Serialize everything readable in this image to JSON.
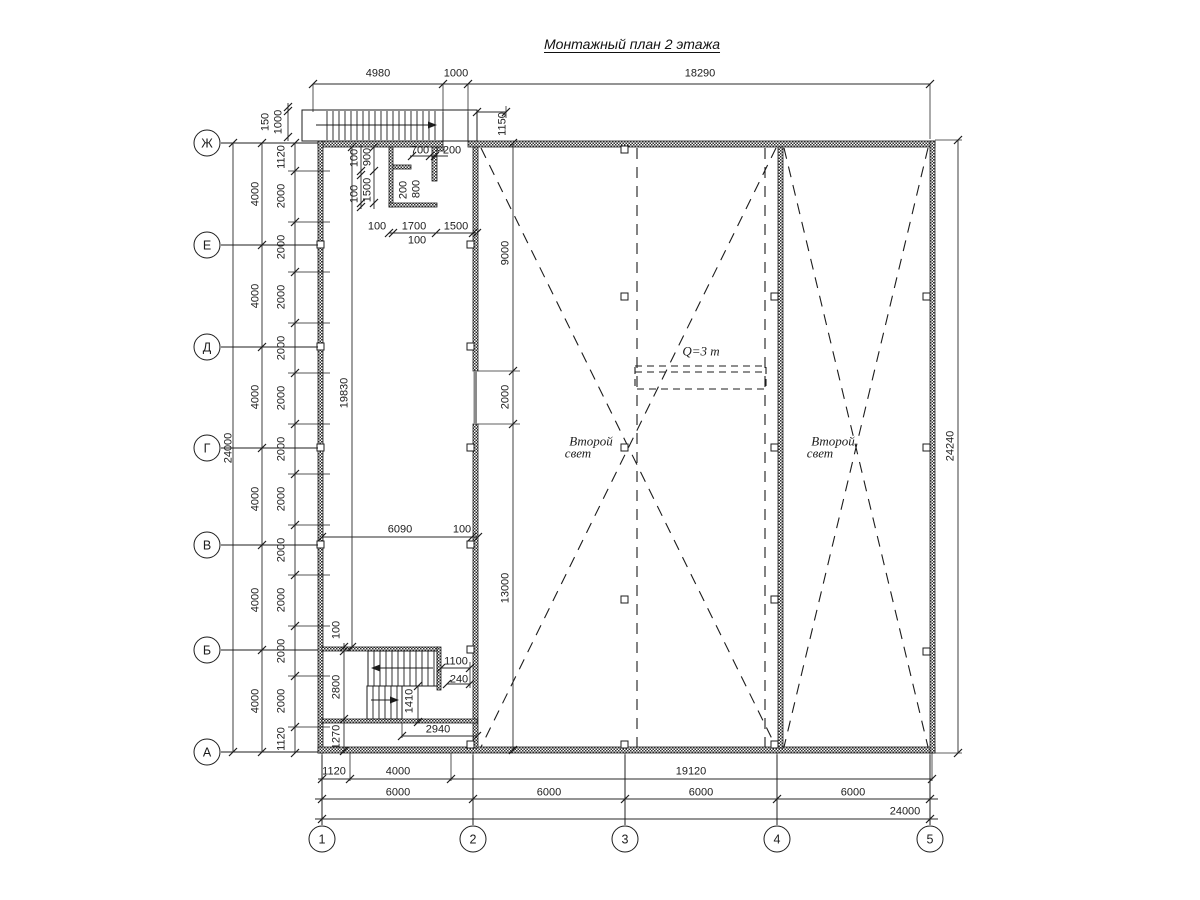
{
  "title": "Монтажный план 2 этажа",
  "colors": {
    "line": "#1c1c1c",
    "background": "#ffffff",
    "wall_opening": "#8a8a8a"
  },
  "axes": {
    "left": [
      {
        "label": "Ж",
        "y": 143
      },
      {
        "label": "Е",
        "y": 245
      },
      {
        "label": "Д",
        "y": 347
      },
      {
        "label": "Г",
        "y": 448
      },
      {
        "label": "В",
        "y": 545
      },
      {
        "label": "Б",
        "y": 650
      },
      {
        "label": "А",
        "y": 752
      }
    ],
    "bottom": [
      {
        "label": "1",
        "x": 322
      },
      {
        "label": "2",
        "x": 473
      },
      {
        "label": "3",
        "x": 625
      },
      {
        "label": "4",
        "x": 777
      },
      {
        "label": "5",
        "x": 930
      }
    ]
  },
  "annotations": [
    {
      "text": "Q=3 m",
      "x": 701,
      "y": 351
    },
    {
      "text": "Второй",
      "x": 591,
      "y": 441
    },
    {
      "text": "свет",
      "x": 578,
      "y": 453
    },
    {
      "text": "Второй",
      "x": 833,
      "y": 441
    },
    {
      "text": "свет",
      "x": 820,
      "y": 453
    }
  ],
  "dim_labels": [
    {
      "t": "4980",
      "x": 378,
      "y": 74,
      "r": 0
    },
    {
      "t": "1000",
      "x": 456,
      "y": 74,
      "r": 0
    },
    {
      "t": "18290",
      "x": 700,
      "y": 74,
      "r": 0
    },
    {
      "t": "150",
      "x": 266,
      "y": 122,
      "r": 1
    },
    {
      "t": "1000",
      "x": 279,
      "y": 122,
      "r": 1
    },
    {
      "t": "1150",
      "x": 503,
      "y": 124,
      "r": 1
    },
    {
      "t": "24000",
      "x": 229,
      "y": 448,
      "r": 1
    },
    {
      "t": "4000",
      "x": 256,
      "y": 194,
      "r": 1
    },
    {
      "t": "4000",
      "x": 256,
      "y": 296,
      "r": 1
    },
    {
      "t": "4000",
      "x": 256,
      "y": 397,
      "r": 1
    },
    {
      "t": "4000",
      "x": 256,
      "y": 499,
      "r": 1
    },
    {
      "t": "4000",
      "x": 256,
      "y": 600,
      "r": 1
    },
    {
      "t": "4000",
      "x": 256,
      "y": 701,
      "r": 1
    },
    {
      "t": "1120",
      "x": 282,
      "y": 157,
      "r": 1
    },
    {
      "t": "2000",
      "x": 282,
      "y": 196,
      "r": 1
    },
    {
      "t": "2000",
      "x": 282,
      "y": 247,
      "r": 1
    },
    {
      "t": "2000",
      "x": 282,
      "y": 297,
      "r": 1
    },
    {
      "t": "2000",
      "x": 282,
      "y": 348,
      "r": 1
    },
    {
      "t": "2000",
      "x": 282,
      "y": 398,
      "r": 1
    },
    {
      "t": "2000",
      "x": 282,
      "y": 449,
      "r": 1
    },
    {
      "t": "2000",
      "x": 282,
      "y": 499,
      "r": 1
    },
    {
      "t": "2000",
      "x": 282,
      "y": 550,
      "r": 1
    },
    {
      "t": "2000",
      "x": 282,
      "y": 600,
      "r": 1
    },
    {
      "t": "2000",
      "x": 282,
      "y": 651,
      "r": 1
    },
    {
      "t": "2000",
      "x": 282,
      "y": 701,
      "r": 1
    },
    {
      "t": "1120",
      "x": 282,
      "y": 739,
      "r": 1
    },
    {
      "t": "100",
      "x": 355,
      "y": 158,
      "r": 1
    },
    {
      "t": "900",
      "x": 368,
      "y": 157,
      "r": 1
    },
    {
      "t": "100",
      "x": 355,
      "y": 194,
      "r": 1
    },
    {
      "t": "1500",
      "x": 368,
      "y": 190,
      "r": 1
    },
    {
      "t": "700",
      "x": 420,
      "y": 151,
      "r": 0
    },
    {
      "t": "200",
      "x": 452,
      "y": 151,
      "r": 0
    },
    {
      "t": "200",
      "x": 404,
      "y": 190,
      "r": 1
    },
    {
      "t": "800",
      "x": 417,
      "y": 189,
      "r": 1
    },
    {
      "t": "100",
      "x": 377,
      "y": 227,
      "r": 0
    },
    {
      "t": "1700",
      "x": 414,
      "y": 227,
      "r": 0
    },
    {
      "t": "1500",
      "x": 456,
      "y": 227,
      "r": 0
    },
    {
      "t": "100",
      "x": 417,
      "y": 241,
      "r": 0
    },
    {
      "t": "19830",
      "x": 345,
      "y": 393,
      "r": 1
    },
    {
      "t": "9000",
      "x": 506,
      "y": 253,
      "r": 1
    },
    {
      "t": "2000",
      "x": 506,
      "y": 397,
      "r": 1
    },
    {
      "t": "13000",
      "x": 506,
      "y": 588,
      "r": 1
    },
    {
      "t": "6090",
      "x": 400,
      "y": 530,
      "r": 0
    },
    {
      "t": "100",
      "x": 462,
      "y": 530,
      "r": 0
    },
    {
      "t": "100",
      "x": 337,
      "y": 630,
      "r": 1
    },
    {
      "t": "2800",
      "x": 337,
      "y": 687,
      "r": 1
    },
    {
      "t": "1270",
      "x": 337,
      "y": 737,
      "r": 1
    },
    {
      "t": "1100",
      "x": 456,
      "y": 662,
      "r": 0
    },
    {
      "t": "240",
      "x": 459,
      "y": 680,
      "r": 0
    },
    {
      "t": "1410",
      "x": 410,
      "y": 701,
      "r": 1
    },
    {
      "t": "2940",
      "x": 438,
      "y": 730,
      "r": 0
    },
    {
      "t": "1120",
      "x": 334,
      "y": 772,
      "r": 0
    },
    {
      "t": "4000",
      "x": 398,
      "y": 772,
      "r": 0
    },
    {
      "t": "19120",
      "x": 691,
      "y": 772,
      "r": 0
    },
    {
      "t": "6000",
      "x": 398,
      "y": 793,
      "r": 0
    },
    {
      "t": "6000",
      "x": 549,
      "y": 793,
      "r": 0
    },
    {
      "t": "6000",
      "x": 701,
      "y": 793,
      "r": 0
    },
    {
      "t": "6000",
      "x": 853,
      "y": 793,
      "r": 0
    },
    {
      "t": "24000",
      "x": 905,
      "y": 812,
      "r": 0
    },
    {
      "t": "24240",
      "x": 951,
      "y": 446,
      "r": 1
    }
  ]
}
